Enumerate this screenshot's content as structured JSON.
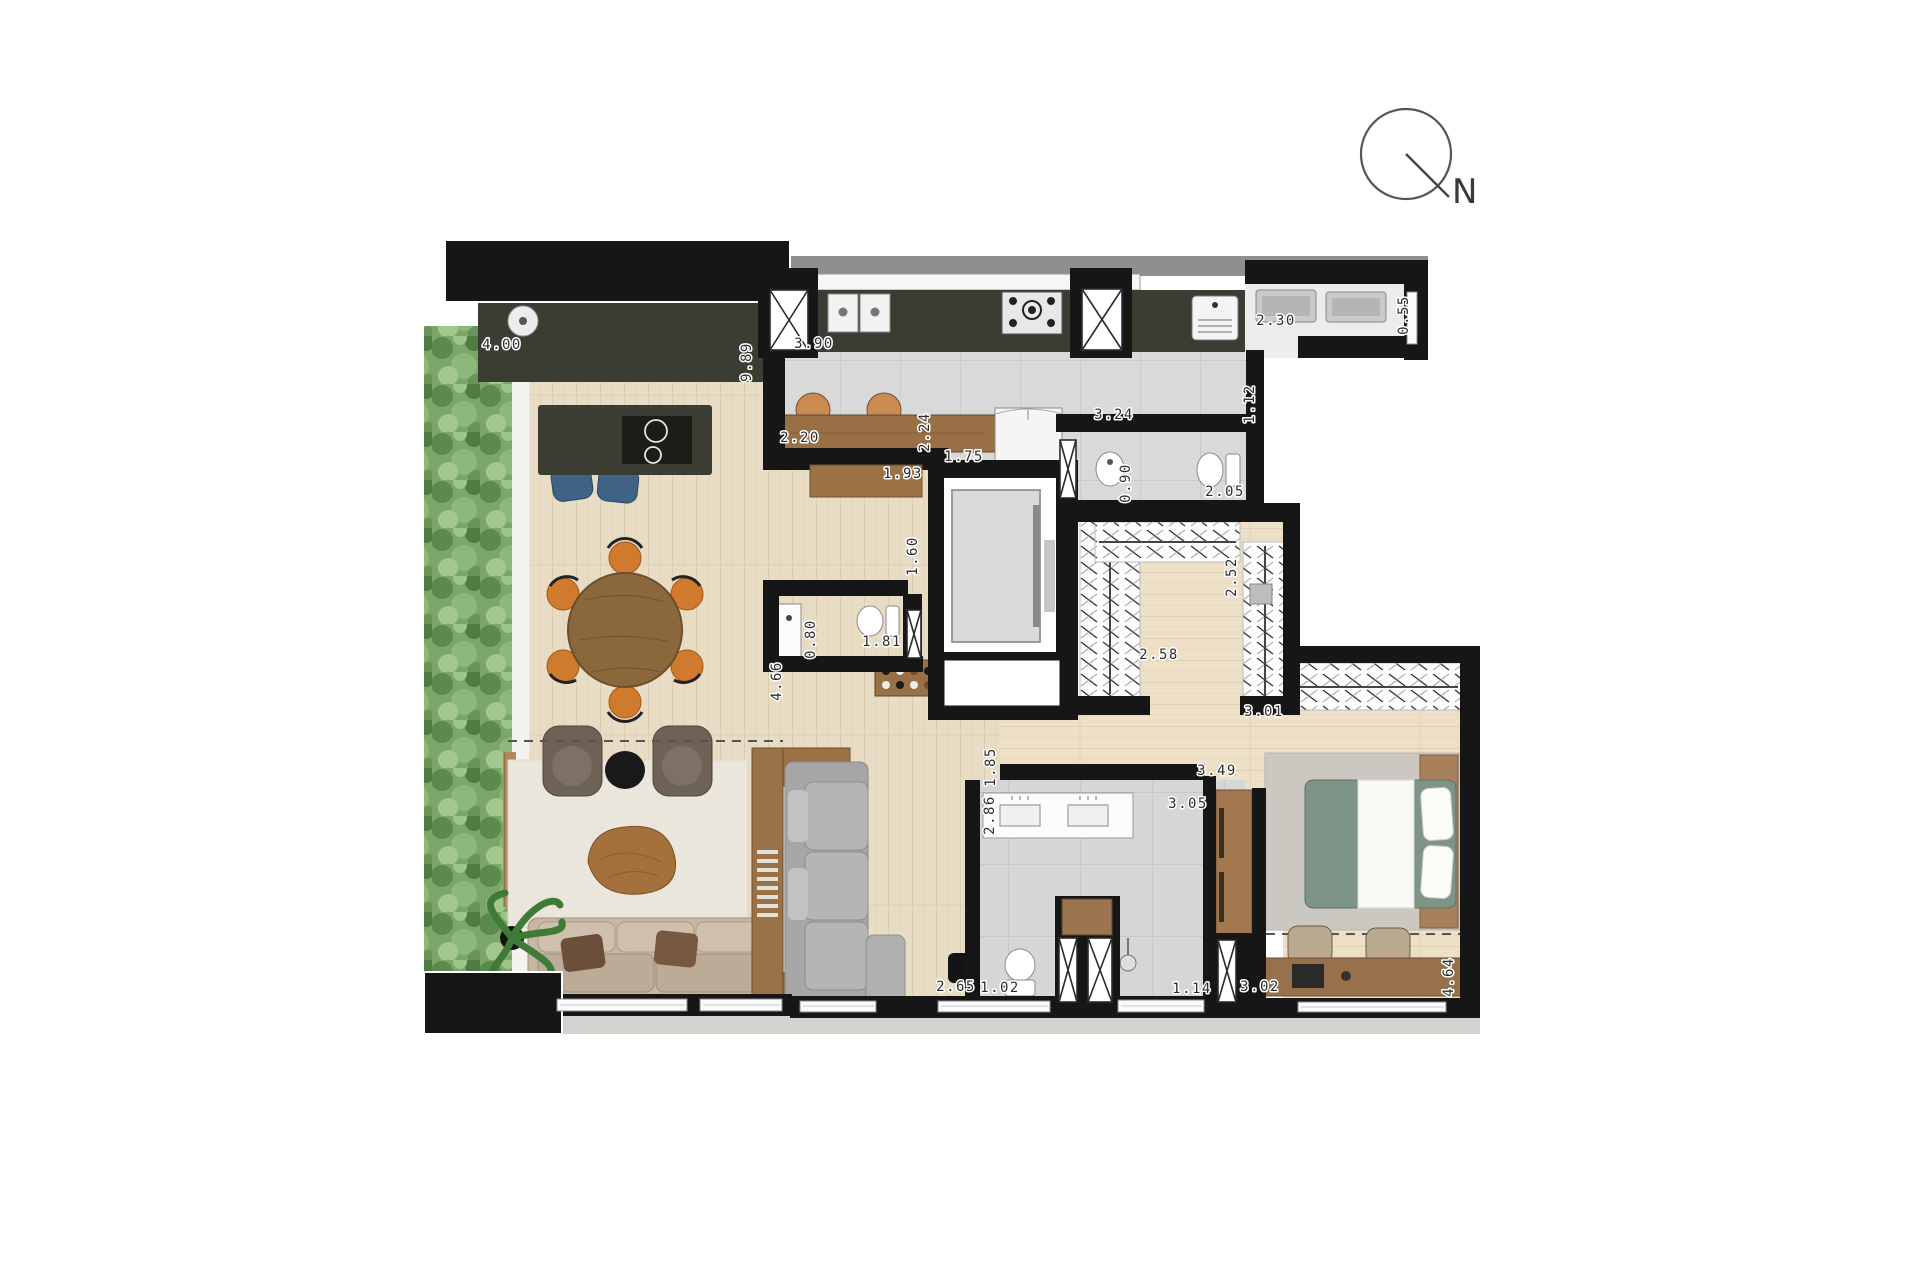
{
  "meta": {
    "title": "Apartment floor plan",
    "north_label": "N"
  },
  "colors": {
    "wall": "#161616",
    "counter": "#3b3d33",
    "wood1": "#e9dcc4",
    "woodline": "#d6c6a8",
    "woodbed": "#eee0c6",
    "tile": "#d9d9da",
    "tileline": "#c2c2c4",
    "hedge": "#7ba569",
    "barwood": "#996f45",
    "furnwood": "#9b7146",
    "sofa": "#c6b6a3",
    "sectional": "#b5b5b5",
    "rug": "#eae6db",
    "ruggrey": "#cbc7c1",
    "bedgreen": "#7e9486",
    "orange": "#d07a2e",
    "blue": "#3e6384"
  },
  "dimensions": [
    {
      "text": "4.00",
      "x": 502,
      "y": 349,
      "rot": 0
    },
    {
      "text": "9.89",
      "x": 751,
      "y": 362,
      "rot": -90
    },
    {
      "text": "3.90",
      "x": 814,
      "y": 348,
      "rot": 0
    },
    {
      "text": "2.20",
      "x": 800,
      "y": 442,
      "rot": 0
    },
    {
      "text": "2.24",
      "x": 929,
      "y": 432,
      "rot": -90
    },
    {
      "text": "1.75",
      "x": 964,
      "y": 461,
      "rot": 0
    },
    {
      "text": "1.93",
      "x": 903,
      "y": 478,
      "rot": 0
    },
    {
      "text": "3.24",
      "x": 1114,
      "y": 419,
      "rot": 0
    },
    {
      "text": "1.12",
      "x": 1254,
      "y": 404,
      "rot": -90
    },
    {
      "text": "2.30",
      "x": 1276,
      "y": 325,
      "rot": 0
    },
    {
      "text": "0.55",
      "x": 1408,
      "y": 315,
      "rot": -90
    },
    {
      "text": "0.90",
      "x": 1130,
      "y": 483,
      "rot": -90
    },
    {
      "text": "2.05",
      "x": 1225,
      "y": 496,
      "rot": 0
    },
    {
      "text": "1.60",
      "x": 917,
      "y": 556,
      "rot": -90
    },
    {
      "text": "2.52",
      "x": 1236,
      "y": 577,
      "rot": -90
    },
    {
      "text": "0.80",
      "x": 815,
      "y": 639,
      "rot": -90
    },
    {
      "text": "1.81",
      "x": 882,
      "y": 646,
      "rot": 0
    },
    {
      "text": "2.58",
      "x": 1159,
      "y": 659,
      "rot": 0
    },
    {
      "text": "3.01",
      "x": 1264,
      "y": 716,
      "rot": 0
    },
    {
      "text": "4.66",
      "x": 781,
      "y": 681,
      "rot": -90
    },
    {
      "text": "1.85",
      "x": 995,
      "y": 767,
      "rot": -90
    },
    {
      "text": "3.49",
      "x": 1217,
      "y": 775,
      "rot": 0
    },
    {
      "text": "2.86",
      "x": 994,
      "y": 815,
      "rot": -90
    },
    {
      "text": "3.05",
      "x": 1188,
      "y": 808,
      "rot": 0
    },
    {
      "text": "2.65",
      "x": 956,
      "y": 991,
      "rot": 0
    },
    {
      "text": "1.02",
      "x": 1000,
      "y": 992,
      "rot": 0
    },
    {
      "text": "1.14",
      "x": 1192,
      "y": 993,
      "rot": 0
    },
    {
      "text": "3.02",
      "x": 1260,
      "y": 991,
      "rot": 0
    },
    {
      "text": "4.64",
      "x": 1453,
      "y": 977,
      "rot": -90
    }
  ]
}
